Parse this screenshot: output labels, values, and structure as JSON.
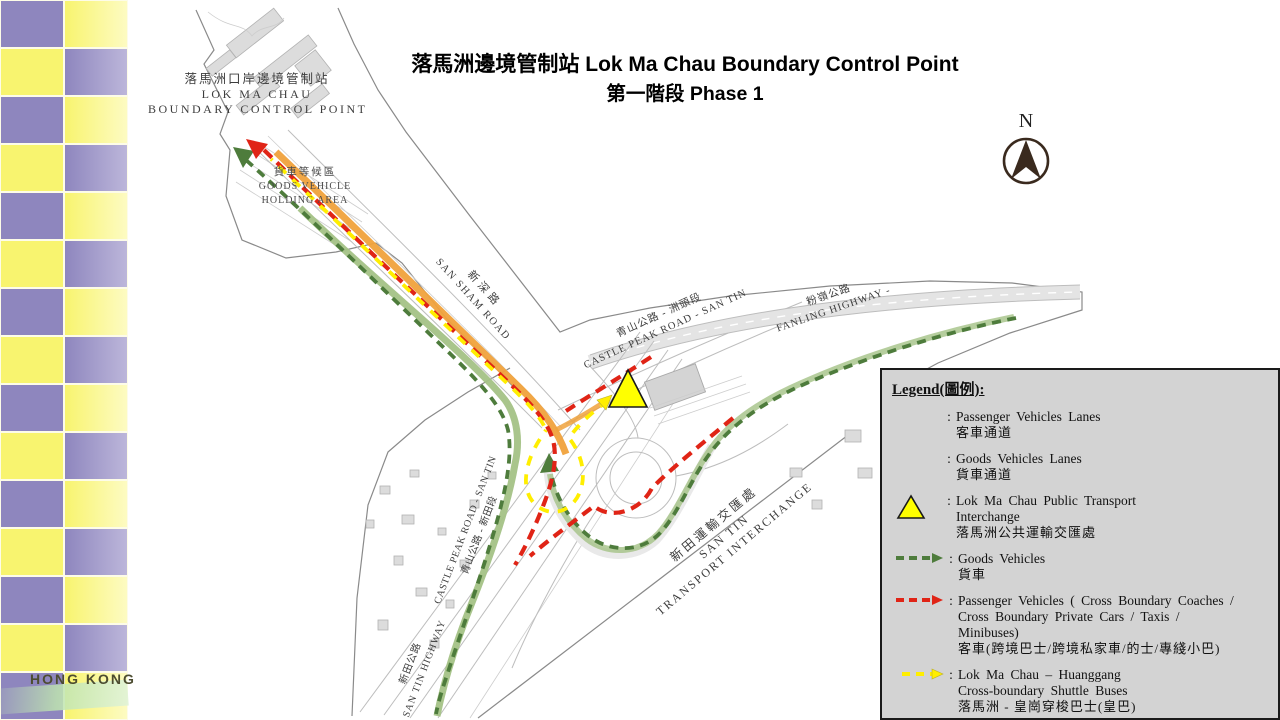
{
  "title": {
    "line1": "落馬洲邊境管制站 Lok Ma Chau Boundary Control Point",
    "line2": "第一階段 Phase 1"
  },
  "sidebar": {
    "brand": "HONG KONG"
  },
  "north": {
    "label": "N"
  },
  "map": {
    "labels": {
      "lmc_bcp": {
        "zh": "落馬洲口岸邊境管制站",
        "en1": "LOK MA CHAU",
        "en2": "BOUNDARY CONTROL POINT"
      },
      "holding": {
        "zh": "貨車等候區",
        "en1": "GOODS VEHICLE",
        "en2": "HOLDING AREA"
      },
      "san_sham": {
        "zh": "新深路",
        "en": "SAN SHAM ROAD"
      },
      "castle_peak_ne": {
        "zh": "青山公路 - 洲頭段",
        "en": "CASTLE PEAK ROAD - SAN TIN"
      },
      "fanling": {
        "zh": "粉嶺公路",
        "en": "FANLING HIGHWAY -"
      },
      "castle_peak_w": {
        "zh": "青山公路 - 新田段",
        "en": "CASTLE PEAK ROAD - SAN TIN"
      },
      "interchange": {
        "zh": "新田運輸交匯處",
        "en1": "SAN TIN",
        "en2": "TRANSPORT INTERCHANGE"
      },
      "san_tin_hwy": {
        "zh": "新田公路",
        "en": "SAN TIN HIGHWAY"
      }
    }
  },
  "legend": {
    "title": "Legend(圖例):",
    "items": [
      {
        "icon": "passenger-lane-swatch",
        "en1": "Passenger Vehicles  Lanes",
        "zh": "客車通道"
      },
      {
        "icon": "goods-lane-swatch",
        "en1": "Goods Vehicles  Lanes",
        "zh": "貨車通道"
      },
      {
        "icon": "pti-triangle",
        "en1": "Lok Ma Chau Public  Transport",
        "en2": "Interchange",
        "zh": "落馬洲公共運輸交匯處"
      },
      {
        "icon": "green-dashed-arrow",
        "en1": "Goods Vehicles",
        "zh": "貨車"
      },
      {
        "icon": "red-dashed-arrow",
        "en1": "Passenger Vehicles  ( Cross Boundary  Coaches /",
        "en2": "Cross Boundary  Private  Cars / Taxis /",
        "en3": "Minibuses)",
        "zh": "客車(跨境巴士/跨境私家車/的士/專綫小巴)"
      },
      {
        "icon": "yellow-dashed-arrow",
        "en1": "Lok Ma Chau – Huanggang",
        "en2": "Cross-boundary  Shuttle  Buses",
        "zh": "落馬洲 - 皇崗穿梭巴士(皇巴)"
      }
    ],
    "colon": ":"
  },
  "colors": {
    "sidebar_yellow": "#F8F46F",
    "sidebar_yellow_light": "#FDFBC2",
    "sidebar_purple": "#8E86BE",
    "sidebar_purple_light": "#BCB6DA",
    "legend_bg": "#D3D3D3",
    "lane_passenger": "#ECC464",
    "lane_passenger_band": "#F0A23C",
    "lane_goods": "#A4C286",
    "pti_yellow": "#FFFF00",
    "route_green": "#4E7C3C",
    "route_red": "#E02416",
    "route_yellow": "#FFEE00",
    "boundary_gray": "#8A8A8A"
  }
}
